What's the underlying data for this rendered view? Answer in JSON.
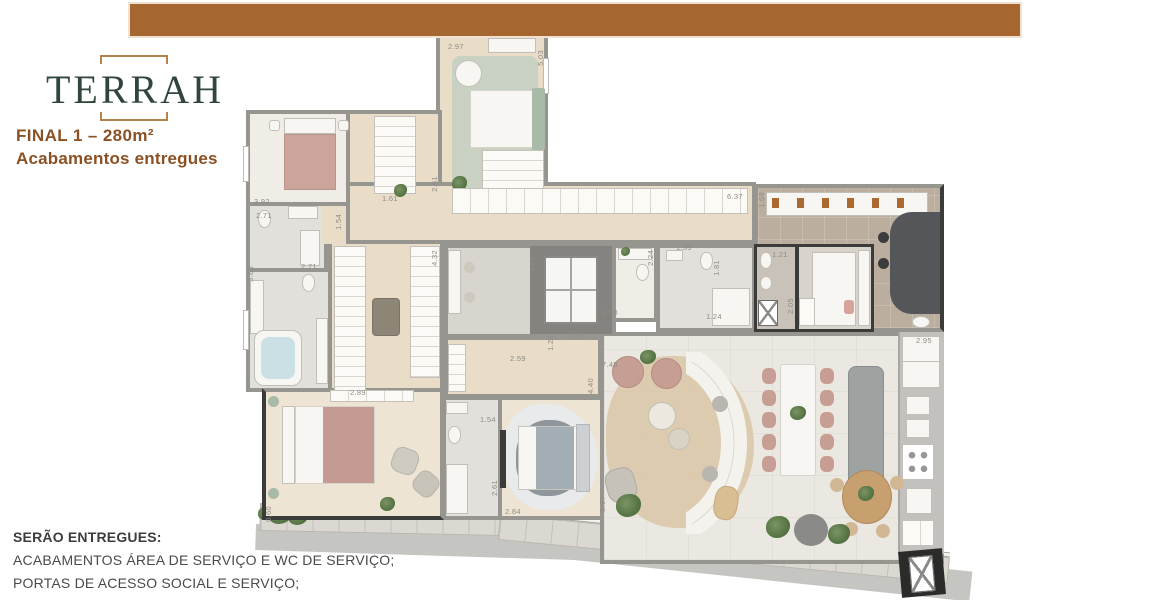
{
  "colors": {
    "bar": "#A5672F",
    "green": "#30463A",
    "brown": "#8A5124",
    "text": "#474747"
  },
  "logo": {
    "brand": "TERRAH",
    "final_line": "FINAL 1 – 280m²",
    "subtitle": "Acabamentos entregues"
  },
  "notes": {
    "title": "SERÃO ENTREGUES:",
    "items": [
      "ACABAMENTOS ÁREA DE SERVIÇO E WC DE SERVIÇO;",
      "PORTAS DE ACESSO SOCIAL E SERVIÇO;",
      "NOS TERRAÇOS ENTREGAREMOS APENAS OS FORROS;"
    ]
  },
  "plan": {
    "dimensions": [
      {
        "t": "2.97",
        "x": 448,
        "y": 42,
        "v": 0
      },
      {
        "t": "5.03",
        "x": 536,
        "y": 50,
        "v": 1
      },
      {
        "t": "2.61",
        "x": 430,
        "y": 176,
        "v": 1
      },
      {
        "t": "1.61",
        "x": 382,
        "y": 194,
        "v": 0
      },
      {
        "t": "3.92",
        "x": 254,
        "y": 197,
        "v": 0
      },
      {
        "t": "2.71",
        "x": 256,
        "y": 211,
        "v": 0
      },
      {
        "t": "1.54",
        "x": 334,
        "y": 214,
        "v": 1
      },
      {
        "t": "3.63",
        "x": 246,
        "y": 266,
        "v": 1
      },
      {
        "t": "2.71",
        "x": 301,
        "y": 262,
        "v": 0
      },
      {
        "t": "2.89",
        "x": 350,
        "y": 388,
        "v": 0
      },
      {
        "t": "4.32",
        "x": 430,
        "y": 250,
        "v": 1
      },
      {
        "t": "2.59",
        "x": 510,
        "y": 354,
        "v": 0
      },
      {
        "t": "6.37",
        "x": 727,
        "y": 192,
        "v": 0
      },
      {
        "t": "1.68",
        "x": 757,
        "y": 192,
        "v": 1
      },
      {
        "t": "1.39",
        "x": 676,
        "y": 243,
        "v": 0
      },
      {
        "t": "2.24",
        "x": 646,
        "y": 250,
        "v": 1
      },
      {
        "t": "1.50",
        "x": 602,
        "y": 308,
        "v": 0
      },
      {
        "t": "1.81",
        "x": 712,
        "y": 260,
        "v": 1
      },
      {
        "t": "1.24",
        "x": 706,
        "y": 312,
        "v": 0
      },
      {
        "t": "1.21",
        "x": 772,
        "y": 250,
        "v": 0
      },
      {
        "t": "2.05",
        "x": 786,
        "y": 298,
        "v": 1
      },
      {
        "t": "2.95",
        "x": 916,
        "y": 336,
        "v": 0
      },
      {
        "t": "1.76",
        "x": 570,
        "y": 331,
        "v": 0
      },
      {
        "t": "1.20",
        "x": 546,
        "y": 335,
        "v": 1
      },
      {
        "t": "4.91",
        "x": 528,
        "y": 256,
        "v": 1
      },
      {
        "t": "7.49",
        "x": 602,
        "y": 360,
        "v": 0
      },
      {
        "t": "4.40",
        "x": 586,
        "y": 378,
        "v": 1
      },
      {
        "t": "5.97",
        "x": 598,
        "y": 496,
        "v": 1
      },
      {
        "t": "1.54",
        "x": 480,
        "y": 415,
        "v": 0
      },
      {
        "t": "2.61",
        "x": 490,
        "y": 480,
        "v": 1
      },
      {
        "t": "2.84",
        "x": 505,
        "y": 507,
        "v": 0
      },
      {
        "t": "0.60",
        "x": 264,
        "y": 506,
        "v": 1
      }
    ]
  }
}
